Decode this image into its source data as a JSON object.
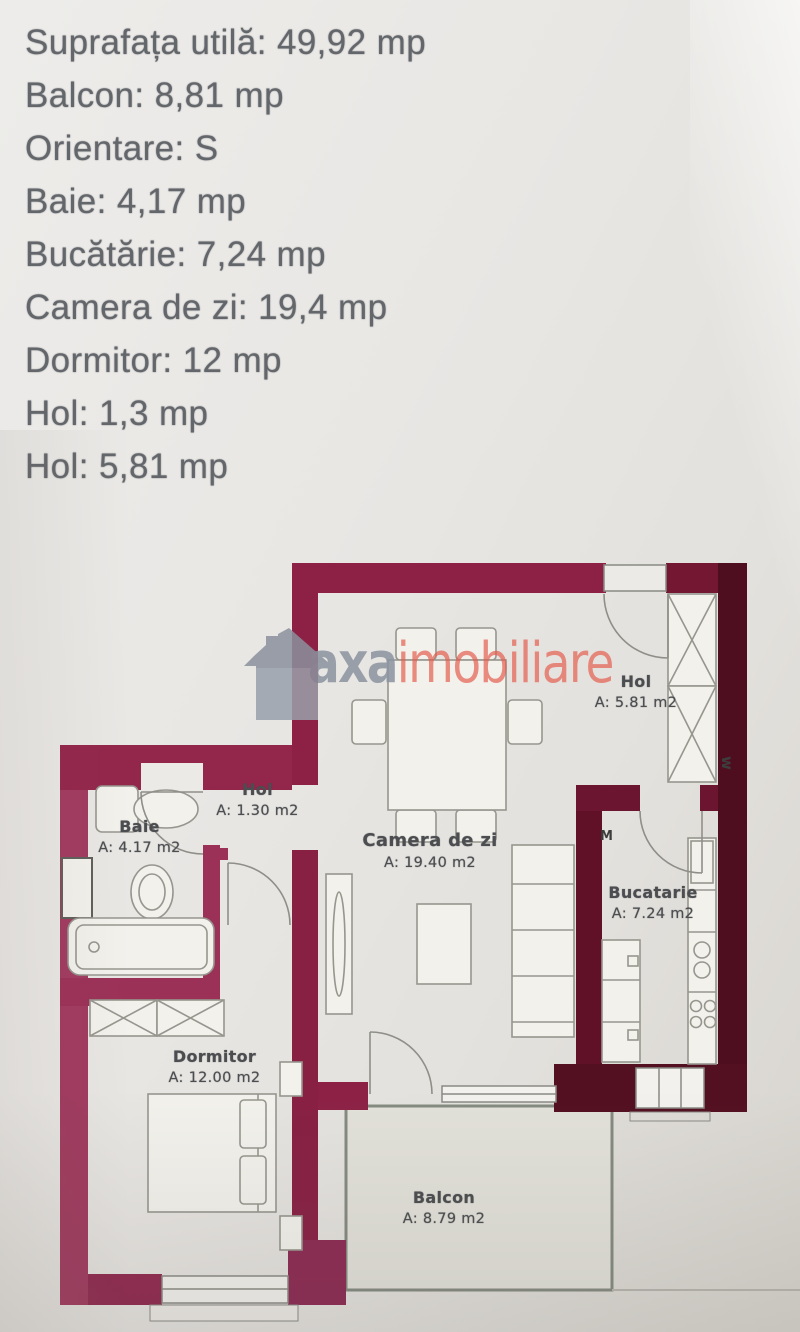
{
  "listing": {
    "lines": [
      "Suprafața utilă: 49,92 mp",
      "Balcon: 8,81 mp",
      "Orientare: S",
      "Baie: 4,17 mp",
      "Bucătărie: 7,24 mp",
      "Camera de zi: 19,4 mp",
      "Dormitor: 12 mp",
      "Hol: 1,3 mp",
      "Hol: 5,81 mp"
    ]
  },
  "watermark": {
    "brand_part1": "axa",
    "brand_part2": "imobiliare",
    "icon": "house-icon",
    "brand_gray": "#8b93a0",
    "brand_red": "#e55a4b"
  },
  "floor_plan": {
    "rooms": {
      "hol_entrance": {
        "name": "Hol",
        "area": "A: 5.81 m2"
      },
      "hol_small": {
        "name": "Hol",
        "area": "A: 1.30 m2"
      },
      "baie": {
        "name": "Baie",
        "area": "A: 4.17 m2"
      },
      "camera_de_zi": {
        "name": "Camera de zi",
        "area": "A: 19.40 m2"
      },
      "bucatarie": {
        "name": "Bucatarie",
        "area": "A: 7.24 m2"
      },
      "dormitor": {
        "name": "Dormitor",
        "area": "A: 12.00 m2"
      },
      "balcon": {
        "name": "Balcon",
        "area": "A: 8.79 m2"
      }
    },
    "markers": {
      "washing_machine": "M",
      "shaft": "w"
    },
    "colors": {
      "wall_light": "#a13a5f",
      "wall_mid": "#8c2145",
      "wall_dark": "#4f0e20",
      "wall_kitchen": "#611127",
      "furniture_line": "#96968e",
      "balcony_line": "#848a80",
      "label_text": "#4b4d50",
      "listing_text": "#63666a"
    }
  }
}
